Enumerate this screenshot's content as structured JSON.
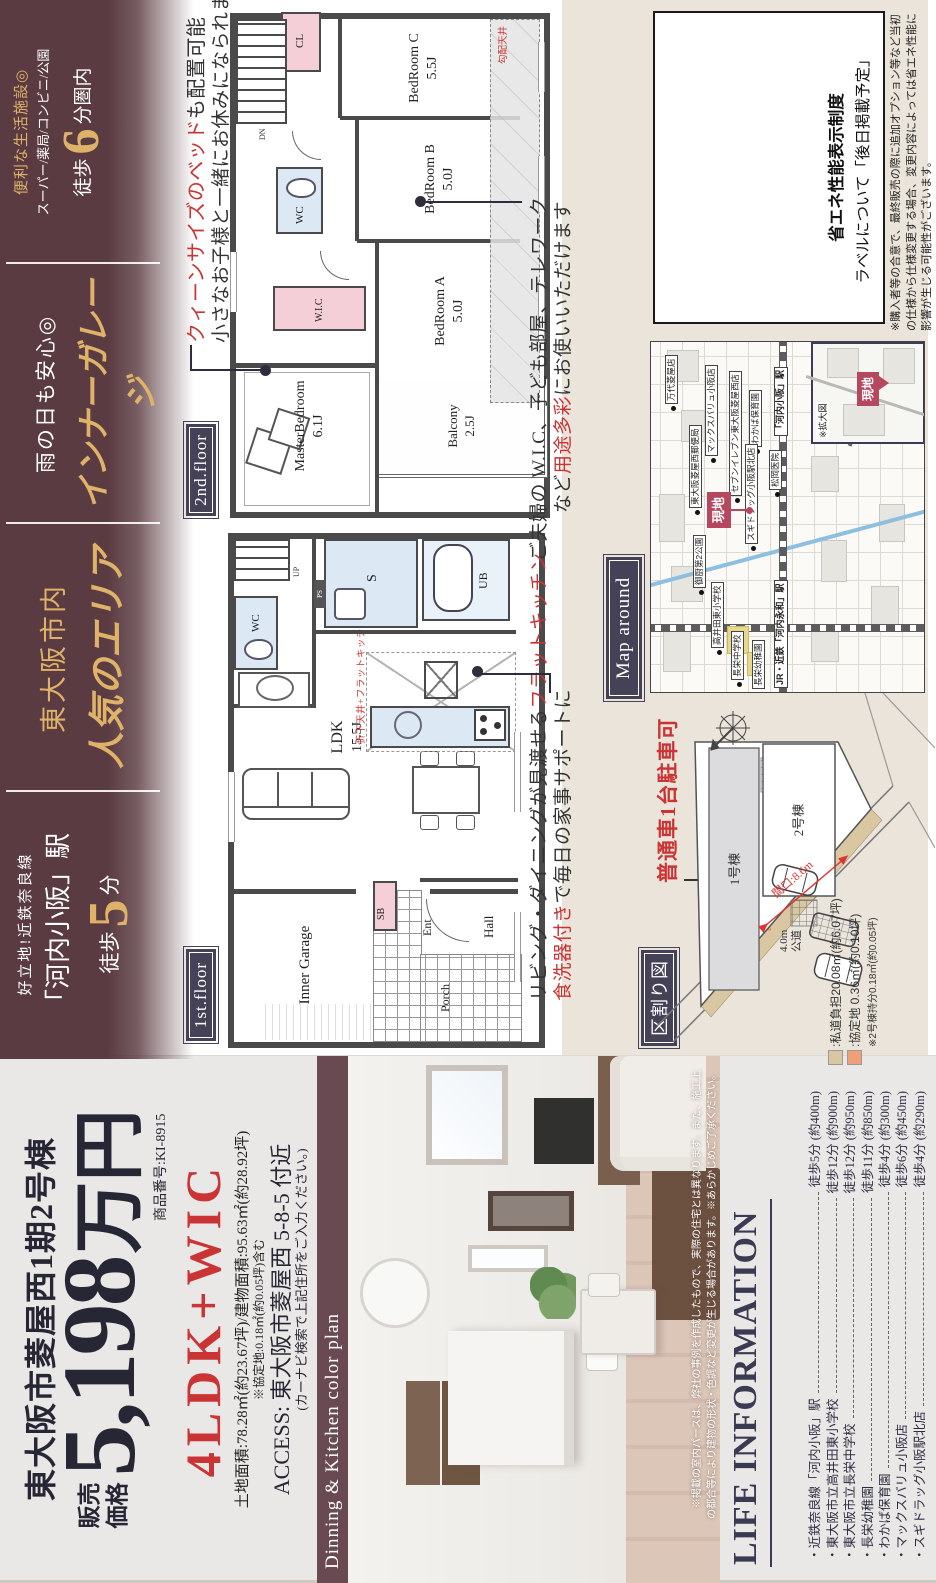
{
  "band": {
    "station": {
      "catch": "好立地!近鉄奈良線",
      "name": "「河内小阪」駅",
      "walk": "徒歩",
      "min": "5",
      "unit": "分"
    },
    "area": {
      "l1": "東大阪市内",
      "l2": "人気のエリア"
    },
    "garage": {
      "l1": "雨の日も安心◎",
      "l2": "インナーガレージ"
    },
    "fac": {
      "l1": "便利な生活施設◎",
      "l2": "スーパー/薬局/コンビニ/公園",
      "walk": "徒歩",
      "min": "6",
      "unit": "分圏内"
    }
  },
  "price": {
    "title": "東大阪市菱屋西1期2号棟",
    "label1": "販売",
    "label2": "価格",
    "amount": "5,198",
    "unit": "万円",
    "code": "商品番号:KI-8915",
    "plan": "4LDK+WIC",
    "areas": "土地面積:78.28㎡(約23.67坪)/建物面積:95.63㎡(約28.92坪)",
    "areas_note": "※協定地:0.18㎡(約0.05坪)含む",
    "access": "ACCESS: 東大阪市菱屋西 5-8-5 付近",
    "access_note": "(カーナビ検索で上記住所をご入力ください。)"
  },
  "photo": {
    "banner": "Dinning & Kitchen color plan",
    "note1": "※掲載の室内パースは、弊社の事例を作成したもので、実際の住宅とは異なります。また、施工上",
    "note2": "の都合等により建物の形状・色調など変更が生じる場合があります。※あらかじめご了承ください。"
  },
  "life": {
    "header": "LIFE INFORMATION",
    "items": [
      {
        "name": "・近鉄奈良線「河内小阪」駅",
        "time": "徒歩5分 (約400m)"
      },
      {
        "name": "・東大阪市立高井田東小学校",
        "time": "徒歩12分 (約900m)"
      },
      {
        "name": "・東大阪市立長栄中学校",
        "time": "徒歩12分 (約950m)"
      },
      {
        "name": "・長栄幼稚園",
        "time": "徒歩11分 (約850m)"
      },
      {
        "name": "・わかば保育園",
        "time": "徒歩4分 (約300m)"
      },
      {
        "name": "・マックスバリュ小阪店",
        "time": "徒歩6分 (約450m)"
      },
      {
        "name": "・スギドラッグ小阪駅北店",
        "time": "徒歩4分 (約290m)"
      }
    ]
  },
  "f1": {
    "label": "1st.floor",
    "rooms": {
      "garage": "Inner Garage",
      "ldk": "LDK",
      "ldk_size": "15.5J",
      "wc": "WC",
      "s": "S",
      "ub": "UB",
      "sb": "SB",
      "ent": "Ent",
      "hall": "Hall",
      "porch": "Porch",
      "up": "UP",
      "ps": "PS"
    },
    "kitchen_note": "折下天井+フラットキッチン",
    "ann": {
      "l1": "リビング・ダイニングが見渡せる",
      "l1r": "フラットキッチン",
      "l2r": "食洗器付き",
      "l2": "で毎日の家事サポートに"
    }
  },
  "f2": {
    "label": "2nd.floor",
    "rooms": {
      "master": "MasterBedroom",
      "master_size": "6.1J",
      "balcony": "Balcony",
      "balcony_size": "2.5J",
      "bedA": "BedRoom A",
      "bedA_size": "5.0J",
      "bedB": "BedRoom B",
      "bedB_size": "5.0J",
      "bedC": "BedRoom C",
      "bedC_size": "5.5J",
      "wic": "W.I.C",
      "wc": "WC",
      "cl": "CL",
      "dn": "DN"
    },
    "ceiling_note": "勾配天井",
    "ann_bed": {
      "r": "クィーンサイズのベッド",
      "b": "も配置可能",
      "l2": "小さなお子様と一緒にお休みになられます"
    },
    "ann_wic": {
      "l1": "ご夫婦の W.I.C、子ども部屋、テレワーク",
      "pre": "など",
      "red": "用途多彩",
      "post": "にお使いいただけます"
    }
  },
  "map": {
    "label": "Map around",
    "genchi": "現地",
    "inset": "※拡大図",
    "station1": "「河内小阪」駅",
    "station2": "JR・近鉄「河内永和」駅",
    "pois": [
      {
        "label": "万代菱屋店"
      },
      {
        "label": "マックスバリュ小阪店"
      },
      {
        "label": "セブンイレブン東大阪菱屋西店"
      },
      {
        "label": "わかば保育園"
      },
      {
        "label": "東大阪菱屋西郵便局"
      },
      {
        "label": "松岡医院"
      },
      {
        "label": "スギドラッグ小阪駅北店"
      },
      {
        "label": "御厨第2公園"
      },
      {
        "label": "高井田東小学校"
      },
      {
        "label": "長栄中学校"
      },
      {
        "label": "長栄幼稚園"
      }
    ]
  },
  "site": {
    "label": "区割り図",
    "note": "普通車1台駐車可",
    "lot1": "1号棟",
    "lot2": "2号棟",
    "frontage": "間口:8.6m",
    "road1": "4.0m",
    "road2": "公道",
    "legend1": ":私道負担20.08㎡(約6.07坪)",
    "legend2": ":協定地 0.36㎡(約0.10坪)",
    "legend3": "※2号棟持分0.18㎡(約0.05坪)"
  },
  "energy": {
    "l1": "省エネ性能表示制度",
    "l2": "ラベルについて「後日掲載予定」",
    "note": "※購入者等の合意で、最終販売の際に追加オプション等など当初の仕様から仕様変更する場合、変更内容によっては省エネ性能に影響が生じる可能性がございます。"
  },
  "colors": {
    "band_brown": "#5a3b41",
    "banner_brown": "#6a4a52",
    "gold": "#deb268",
    "navy": "#454258",
    "ink": "#262634",
    "accent_red": "#cb3434",
    "site_rose": "#b5475f",
    "beige": "#eae4da",
    "gray_bg": "#e9e8e6",
    "closet_pink": "#f4cfd7",
    "wet_blue": "#dce9f4",
    "school_yellow": "#e7d88e",
    "legend_tan": "#d8c7a1",
    "legend_orange": "#f0a077"
  }
}
